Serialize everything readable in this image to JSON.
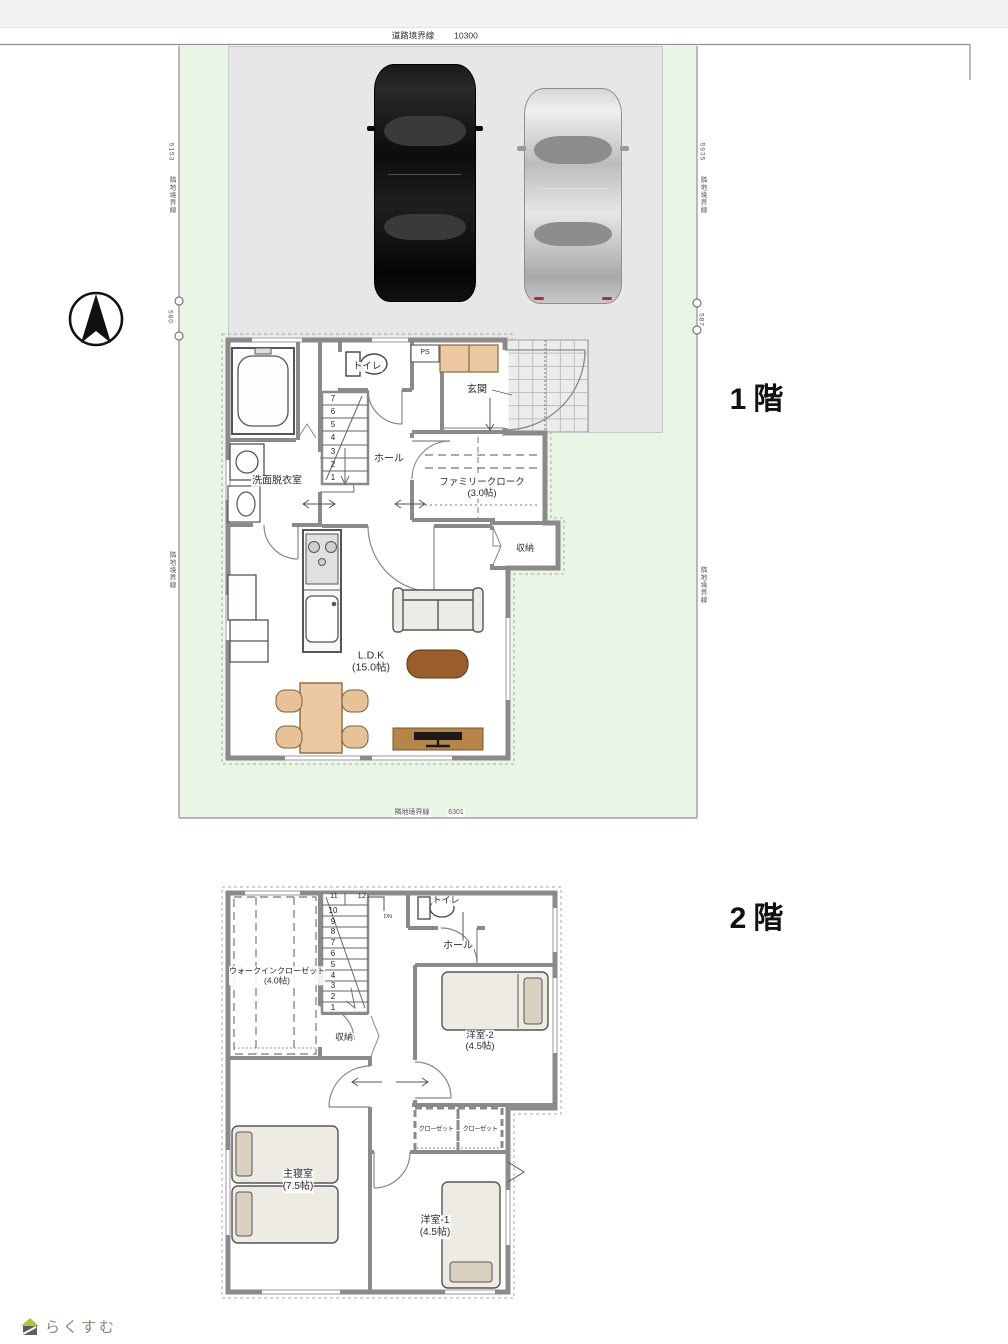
{
  "site": {
    "road_boundary_label": "道路境界線",
    "road_boundary_value": "10300",
    "bottom_boundary_label": "隣地境界線",
    "bottom_boundary_value": "6301",
    "left_top_value": "5153",
    "left_top_label": "隣地境界線",
    "left_mid_value": "580",
    "left_low_label": "隣地境界線",
    "right_top_value": "5935",
    "right_top_label": "隣地境界線",
    "right_mid_value": "587",
    "right_low_label": "隣地境界線"
  },
  "floor1": {
    "title": "1階",
    "rooms": {
      "toilet": "トイレ",
      "ps": "PS",
      "entrance": "玄関",
      "hall": "ホール",
      "washroom": "洗面脱衣室",
      "family_cloak": "ファミリークローク",
      "family_cloak_size": "(3.0帖)",
      "storage": "収納",
      "ldk": "L.D.K",
      "ldk_size": "(15.0帖)"
    },
    "stair_numbers": [
      "7",
      "6",
      "5",
      "4",
      "3",
      "2",
      "1"
    ]
  },
  "floor2": {
    "title": "2階",
    "rooms": {
      "toilet": "トイレ",
      "dn": "DN",
      "hall": "ホール",
      "wic": "ウォークインクローゼット",
      "wic_size": "(4.0帖)",
      "storage": "収納",
      "west_room2": "洋室-2",
      "west_room2_size": "(4.5帖)",
      "closet_a": "クローゼット",
      "closet_b": "クローゼット",
      "master": "主寝室",
      "master_size": "(7.5帖)",
      "west_room1": "洋室-1",
      "west_room1_size": "(4.5帖)"
    },
    "stair_top_numbers": [
      "11",
      "12"
    ],
    "stair_numbers": [
      "10",
      "9",
      "8",
      "7",
      "6",
      "5",
      "4",
      "3",
      "2",
      "1"
    ]
  },
  "logo": {
    "text": "らくすむ"
  },
  "colors": {
    "site_green": "#e9f6e6",
    "parking_gray": "#e7e7e7",
    "wall_gray": "#8a8a8a",
    "cabinet_tan": "#ecc9a0",
    "table_brown": "#9a5d2c",
    "tv_board_brown": "#b5854a",
    "bed_beige": "#edebe4",
    "pillow_tan": "#d9d0bf",
    "logo_green": "#a8c838",
    "logo_text": "#8d8577"
  }
}
